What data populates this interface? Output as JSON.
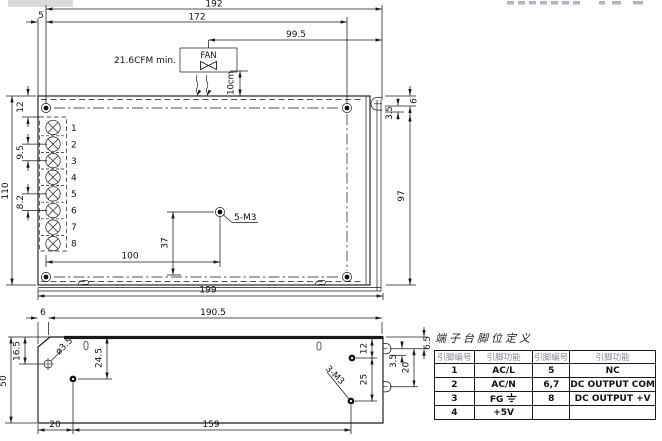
{
  "top_view": {
    "dim_192": "192",
    "dim_172": "172",
    "dim_5": "5",
    "dim_99_5": "99.5",
    "fan_label": "FAN",
    "fan_airflow": "21.6CFM min.",
    "fan_clearance": "10cm",
    "dim_12": "12",
    "dim_9_5": "9.5",
    "dim_8_2": "8.2",
    "dim_110": "110",
    "dim_100": "100",
    "dim_37": "37",
    "hole_label": "5-M3",
    "dim_6": "6",
    "dim_3_5": "3.5",
    "dim_97": "97",
    "dim_199": "199",
    "terminals": [
      "1",
      "2",
      "3",
      "4",
      "5",
      "6",
      "7",
      "8"
    ]
  },
  "side_view": {
    "dim_6": "6",
    "dim_190_5": "190.5",
    "dim_16_5": "16.5",
    "dim_50": "50",
    "hole_dia": "ø3.5",
    "dim_24_5": "24.5",
    "dim_20_bottom": "20",
    "dim_159": "159",
    "dim_12": "12",
    "dim_25": "25",
    "hole_label": "3-M3",
    "dim_6_5": "6.5",
    "dim_3_5": "3.5",
    "dim_20_right": "20"
  },
  "pin_table": {
    "title": "端子台脚位定义",
    "headers": [
      "引脚编号",
      "引脚功能",
      "引脚编号",
      "引脚功能"
    ],
    "rows": [
      {
        "pin_l": "1",
        "func_l": "AC/L",
        "pin_r": "5",
        "func_r": "NC"
      },
      {
        "pin_l": "2",
        "func_l": "AC/N",
        "pin_r": "6,7",
        "func_r": "DC OUTPUT COM"
      },
      {
        "pin_l": "3",
        "func_l": "FG",
        "pin_r": "8",
        "func_r": "DC OUTPUT +V"
      },
      {
        "pin_l": "4",
        "func_l": "+5V",
        "pin_r": "",
        "func_r": ""
      }
    ]
  }
}
